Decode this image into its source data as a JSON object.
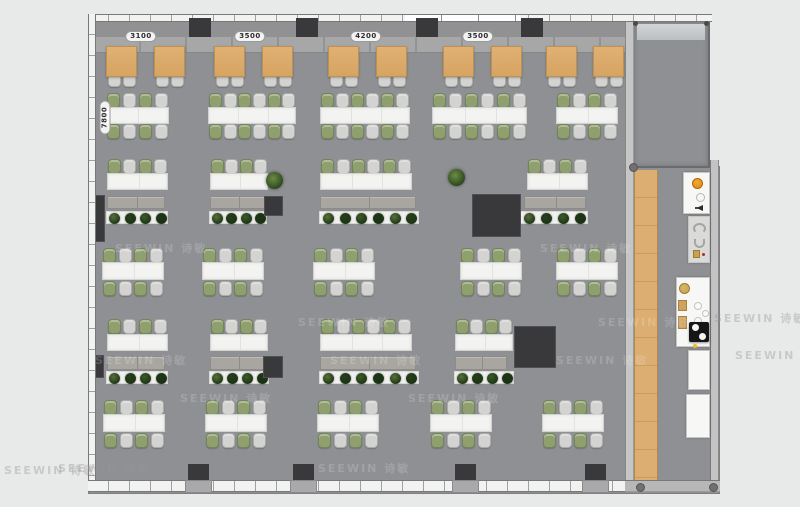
{
  "watermark": {
    "text": "SEEWIN 诗敏"
  },
  "dimensions": {
    "top": [
      {
        "label": "3100",
        "cx": 141
      },
      {
        "label": "3500",
        "cx": 250
      },
      {
        "label": "4200",
        "cx": 366
      },
      {
        "label": "3500",
        "cx": 478
      }
    ],
    "left": {
      "label": "7800"
    }
  },
  "colors": {
    "bg": "#e8e9e9",
    "floor": "#8e9093",
    "wall_line": "#77787a",
    "window": "#f2f2f1",
    "strip_upper": "#919194",
    "strip_lower": "#a7a7a7",
    "wood": "#dcae72",
    "wood_line": "#c99b5f",
    "table": "#dcab6c",
    "table_border": "#bd9054",
    "desk": "#f3f3f1",
    "desk_border": "#d2d2d0",
    "desk_seam": "#e2e2e0",
    "chair_green": "#8fa06e",
    "chair_green_border": "#72845a",
    "chair_gray": "#d3d3d1",
    "chair_gray_border": "#ababa9",
    "cabinet": "#a9a6a1",
    "cabinet_border": "#8f8c88",
    "planter": "#f1f1ef",
    "plants": [
      "#55713a",
      "#24401c",
      "#3a5c28",
      "#1d3517"
    ],
    "dark_block": "#39393b",
    "fixture_white": "#f7f7f6",
    "fixture_gray": "#dadad8",
    "fixture_border": "#c6c6c4",
    "orange": "#e0880e",
    "tan": "#c8a24e",
    "cook_black": "#161616",
    "yellow": "#e8c020"
  },
  "furniture": {
    "wood_tables": {
      "y": 46,
      "w": 31,
      "h": 31,
      "chair_y": 71,
      "xs": [
        106,
        154,
        214,
        262,
        328,
        376,
        443,
        491,
        546,
        593
      ]
    },
    "bench_rows": [
      {
        "chair_top_y": 93,
        "desk_y": 107,
        "desk_h": 17,
        "chair_bot_y": 124,
        "clusters": [
          {
            "x": 105,
            "w": 64,
            "n": 4
          },
          {
            "x": 208,
            "w": 88,
            "n": 6
          },
          {
            "x": 320,
            "w": 90,
            "n": 6
          },
          {
            "x": 432,
            "w": 95,
            "n": 6
          },
          {
            "x": 556,
            "w": 62,
            "n": 4
          }
        ]
      },
      {
        "chair_top_y": 248,
        "desk_y": 262,
        "desk_h": 18,
        "chair_bot_y": 281,
        "clusters": [
          {
            "x": 102,
            "w": 62,
            "n": 4
          },
          {
            "x": 202,
            "w": 62,
            "n": 4
          },
          {
            "x": 313,
            "w": 62,
            "n": 4
          },
          {
            "x": 460,
            "w": 62,
            "n": 4
          },
          {
            "x": 556,
            "w": 62,
            "n": 4
          }
        ]
      },
      {
        "chair_top_y": 400,
        "desk_y": 414,
        "desk_h": 18,
        "chair_bot_y": 433,
        "clusters": [
          {
            "x": 103,
            "w": 62,
            "n": 4
          },
          {
            "x": 205,
            "w": 62,
            "n": 4
          },
          {
            "x": 317,
            "w": 62,
            "n": 4
          },
          {
            "x": 430,
            "w": 62,
            "n": 4
          },
          {
            "x": 542,
            "w": 62,
            "n": 4
          }
        ]
      }
    ],
    "desk_groups": [
      {
        "chair_y": 159,
        "desk_y": 173,
        "desk_h": 17,
        "cab_y": 196,
        "cab_h": 13,
        "pl_y": 211,
        "pl_h": 13,
        "groups": [
          {
            "x": 107,
            "w": 61,
            "n": 4,
            "cab_w": 58,
            "pl_w": 62,
            "plants": 4
          },
          {
            "x": 210,
            "w": 58,
            "n": 4,
            "cab_w": 56,
            "pl_w": 58,
            "plants": 4
          },
          {
            "x": 320,
            "w": 92,
            "n": 6,
            "cab_w": 96,
            "pl_w": 100,
            "plants": 6
          },
          {
            "x": 527,
            "w": 61,
            "n": 4,
            "cab_x": 524,
            "cab_w": 62,
            "pl_x": 520,
            "pl_w": 68,
            "plants": 4
          }
        ]
      },
      {
        "chair_y": 319,
        "desk_y": 334,
        "desk_h": 17,
        "cab_y": 356,
        "cab_h": 14,
        "pl_y": 371,
        "pl_h": 13,
        "groups": [
          {
            "x": 107,
            "w": 61,
            "n": 4,
            "cab_w": 58,
            "pl_w": 62,
            "plants": 4
          },
          {
            "x": 210,
            "w": 58,
            "n": 4,
            "cab_w": 56,
            "pl_w": 60,
            "plants": 4
          },
          {
            "x": 320,
            "w": 92,
            "n": 6,
            "cab_w": 96,
            "pl_w": 100,
            "plants": 6
          },
          {
            "x": 455,
            "w": 58,
            "n": 4,
            "cab_w": 52,
            "pl_w": 60,
            "plants": 4
          }
        ]
      }
    ],
    "potted_plants": [
      {
        "x": 266,
        "y": 172
      },
      {
        "x": 448,
        "y": 169
      }
    ],
    "dark_blocks": [
      {
        "x": 88,
        "y": 195,
        "w": 17,
        "h": 47
      },
      {
        "x": 264,
        "y": 196,
        "w": 19,
        "h": 20
      },
      {
        "x": 472,
        "y": 194,
        "w": 49,
        "h": 43
      },
      {
        "x": 91,
        "y": 355,
        "w": 13,
        "h": 23
      },
      {
        "x": 263,
        "y": 356,
        "w": 20,
        "h": 22
      },
      {
        "x": 514,
        "y": 326,
        "w": 42,
        "h": 42
      }
    ],
    "top_columns_x": [
      189,
      296,
      416,
      521
    ],
    "bottom_columns_x": [
      188,
      293,
      455,
      585
    ]
  },
  "fixtures": [
    {
      "name": "beverage-station",
      "x": 683,
      "y": 172,
      "w": 27,
      "h": 42,
      "fill": "white",
      "details": "beverage"
    },
    {
      "name": "sanitary-unit",
      "x": 688,
      "y": 216,
      "w": 22,
      "h": 47,
      "fill": "gray",
      "details": "sanitary"
    },
    {
      "name": "kitchen-cooktop-unit",
      "x": 676,
      "y": 277,
      "w": 34,
      "h": 70,
      "fill": "white",
      "details": "cooktop"
    },
    {
      "name": "counter-unit",
      "x": 688,
      "y": 350,
      "w": 22,
      "h": 40,
      "fill": "white",
      "details": ""
    },
    {
      "name": "counter-unit",
      "x": 686,
      "y": 394,
      "w": 24,
      "h": 44,
      "fill": "white",
      "details": ""
    }
  ]
}
